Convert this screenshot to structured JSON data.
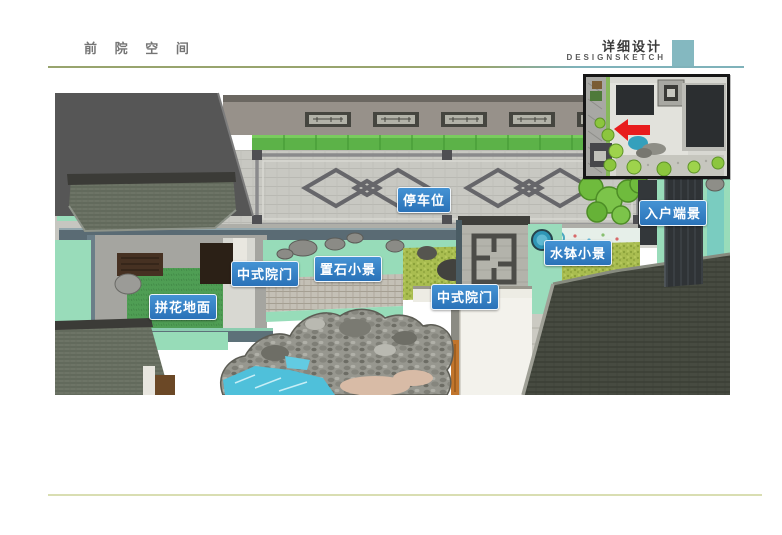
{
  "header": {
    "title": "前 院 空 间",
    "section_title": "详细设计",
    "section_subtitle": "DESIGNSKETCH",
    "accent_square_color": "#84b8c0"
  },
  "annotations": {
    "style": {
      "background": "#2d7cc4",
      "text_color": "#ffffff",
      "border_color": "#ffffff"
    },
    "items": [
      {
        "id": "parking-space",
        "text": "停车位"
      },
      {
        "id": "entry-focal-view",
        "text": "入户端景"
      },
      {
        "id": "water-basin-scene",
        "text": "水钵小景"
      },
      {
        "id": "placed-rock-scene",
        "text": "置石小景"
      },
      {
        "id": "chinese-gate-left",
        "text": "中式院门"
      },
      {
        "id": "mosaic-paving",
        "text": "拼花地面"
      },
      {
        "id": "chinese-gate-right",
        "text": "中式院门"
      }
    ]
  },
  "inset_map": {
    "arrow_color": "#e81c1c"
  },
  "palette": {
    "label_blue": "#2d7cc4",
    "mint_ground": "#99dcba",
    "tile_green": "#5cb248",
    "water_cyan": "#4fc0da",
    "dark_roof": "#474b41",
    "accent_teal": "#84b8c0",
    "header_rule_olive": "#98a46e",
    "header_rule_teal": "#7fb2ba",
    "footer_rule": "#d9deb2"
  }
}
